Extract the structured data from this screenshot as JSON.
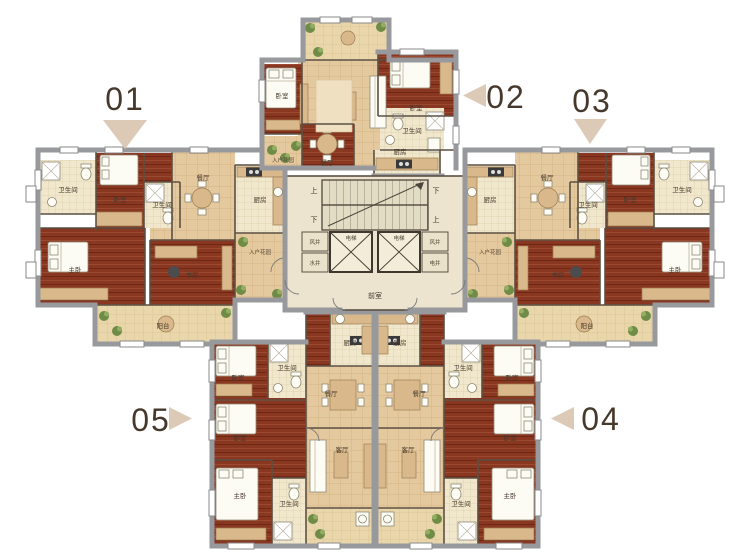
{
  "units": [
    {
      "number": "01",
      "arrow": "down"
    },
    {
      "number": "02",
      "arrow": "left"
    },
    {
      "number": "03",
      "arrow": "down"
    },
    {
      "number": "04",
      "arrow": "left"
    },
    {
      "number": "05",
      "arrow": "right"
    }
  ],
  "rooms": {
    "master": "主卧",
    "bedroom": "卧室",
    "study": "书房",
    "living": "客厅",
    "dining": "餐厅",
    "kitchen": "厨房",
    "bath": "卫生间",
    "balcony": "阳台",
    "entry_garden": "入户花园",
    "lobby": "前室",
    "air_shaft": "风井",
    "water_shaft": "水井",
    "elec_shaft": "电井",
    "elevator": "电梯",
    "stairs_up": "上",
    "stairs_down": "下"
  },
  "colors": {
    "bedroom_floor": "#8a3722",
    "tile_floor": "#e5c99e",
    "bath_floor": "#f0e7cc",
    "balcony_floor": "#e9d7ab",
    "wall_gray": "#97999c",
    "wall_dark": "#5c5044",
    "plant_green": "#6f8c46",
    "arrow_triangle": "#dcc9b6",
    "label_text": "#46392c",
    "background": "#ffffff"
  }
}
